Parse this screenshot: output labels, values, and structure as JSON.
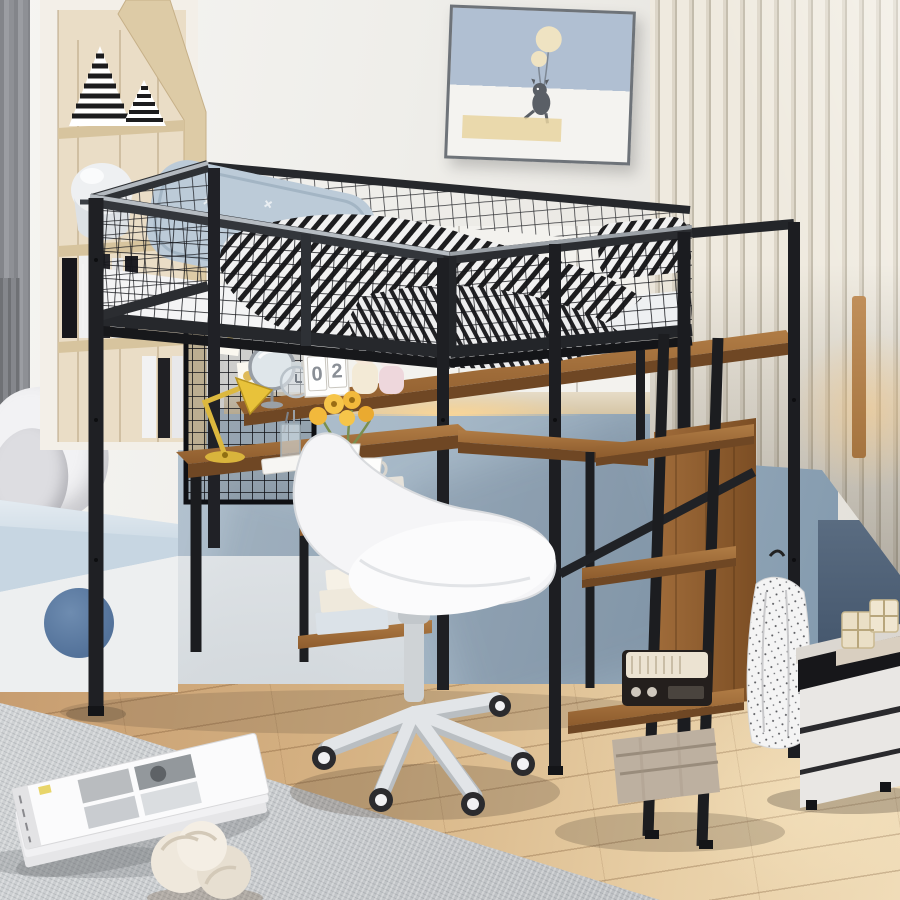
{
  "meta": {
    "title": "Loft bed with desk, storage staircase and wardrobe — bedroom product photo",
    "scene_type": "3d-rendered kids bedroom"
  },
  "calendar_blocks": {
    "digit1": "0",
    "digit2": "2"
  },
  "palette": {
    "metal_frame": "#1b1c1f",
    "rail_highlight": "#aeb4ba",
    "wood_shelf": "#9c6b3f",
    "wood_floor": "#d6b384",
    "wall_white": "#f0efec",
    "wall_blue": "#a6b8c7",
    "wall_dark_blue": "#4a5c72",
    "slat_panel": "#e6e0d4",
    "bedding_blue": "#bccbd8",
    "zebra_black": "#1d1d1f",
    "chair_white": "#f5f5f7",
    "rug_gray": "#c5c8ca",
    "cushion_blue": "#c7d6e2",
    "accent_circle": "#5f80a6",
    "lamp_yellow": "#e8c23a",
    "flower_yellow": "#f2b93c",
    "nightstand_white": "#e9e7e4"
  },
  "objects": [
    "loft bed with mesh guardrail",
    "zebra pattern comforter",
    "blue pillow",
    "cat and balloons wall art",
    "built-in nook shelf with striped cones, helmet and books",
    "gray curtain",
    "window seat with blue cushion and pillows",
    "grid pegboard with photo cards",
    "wood desk with yellow lamp, sunflowers vase, coffee cup and books",
    "white swivel desk chair",
    "storage staircase with wood steps",
    "vintage radio",
    "wood crate",
    "hanging white garment",
    "white nightstand with gift boxes",
    "gray rug with magazines",
    "knot pillow",
    "house-shaped calendar blocks"
  ]
}
